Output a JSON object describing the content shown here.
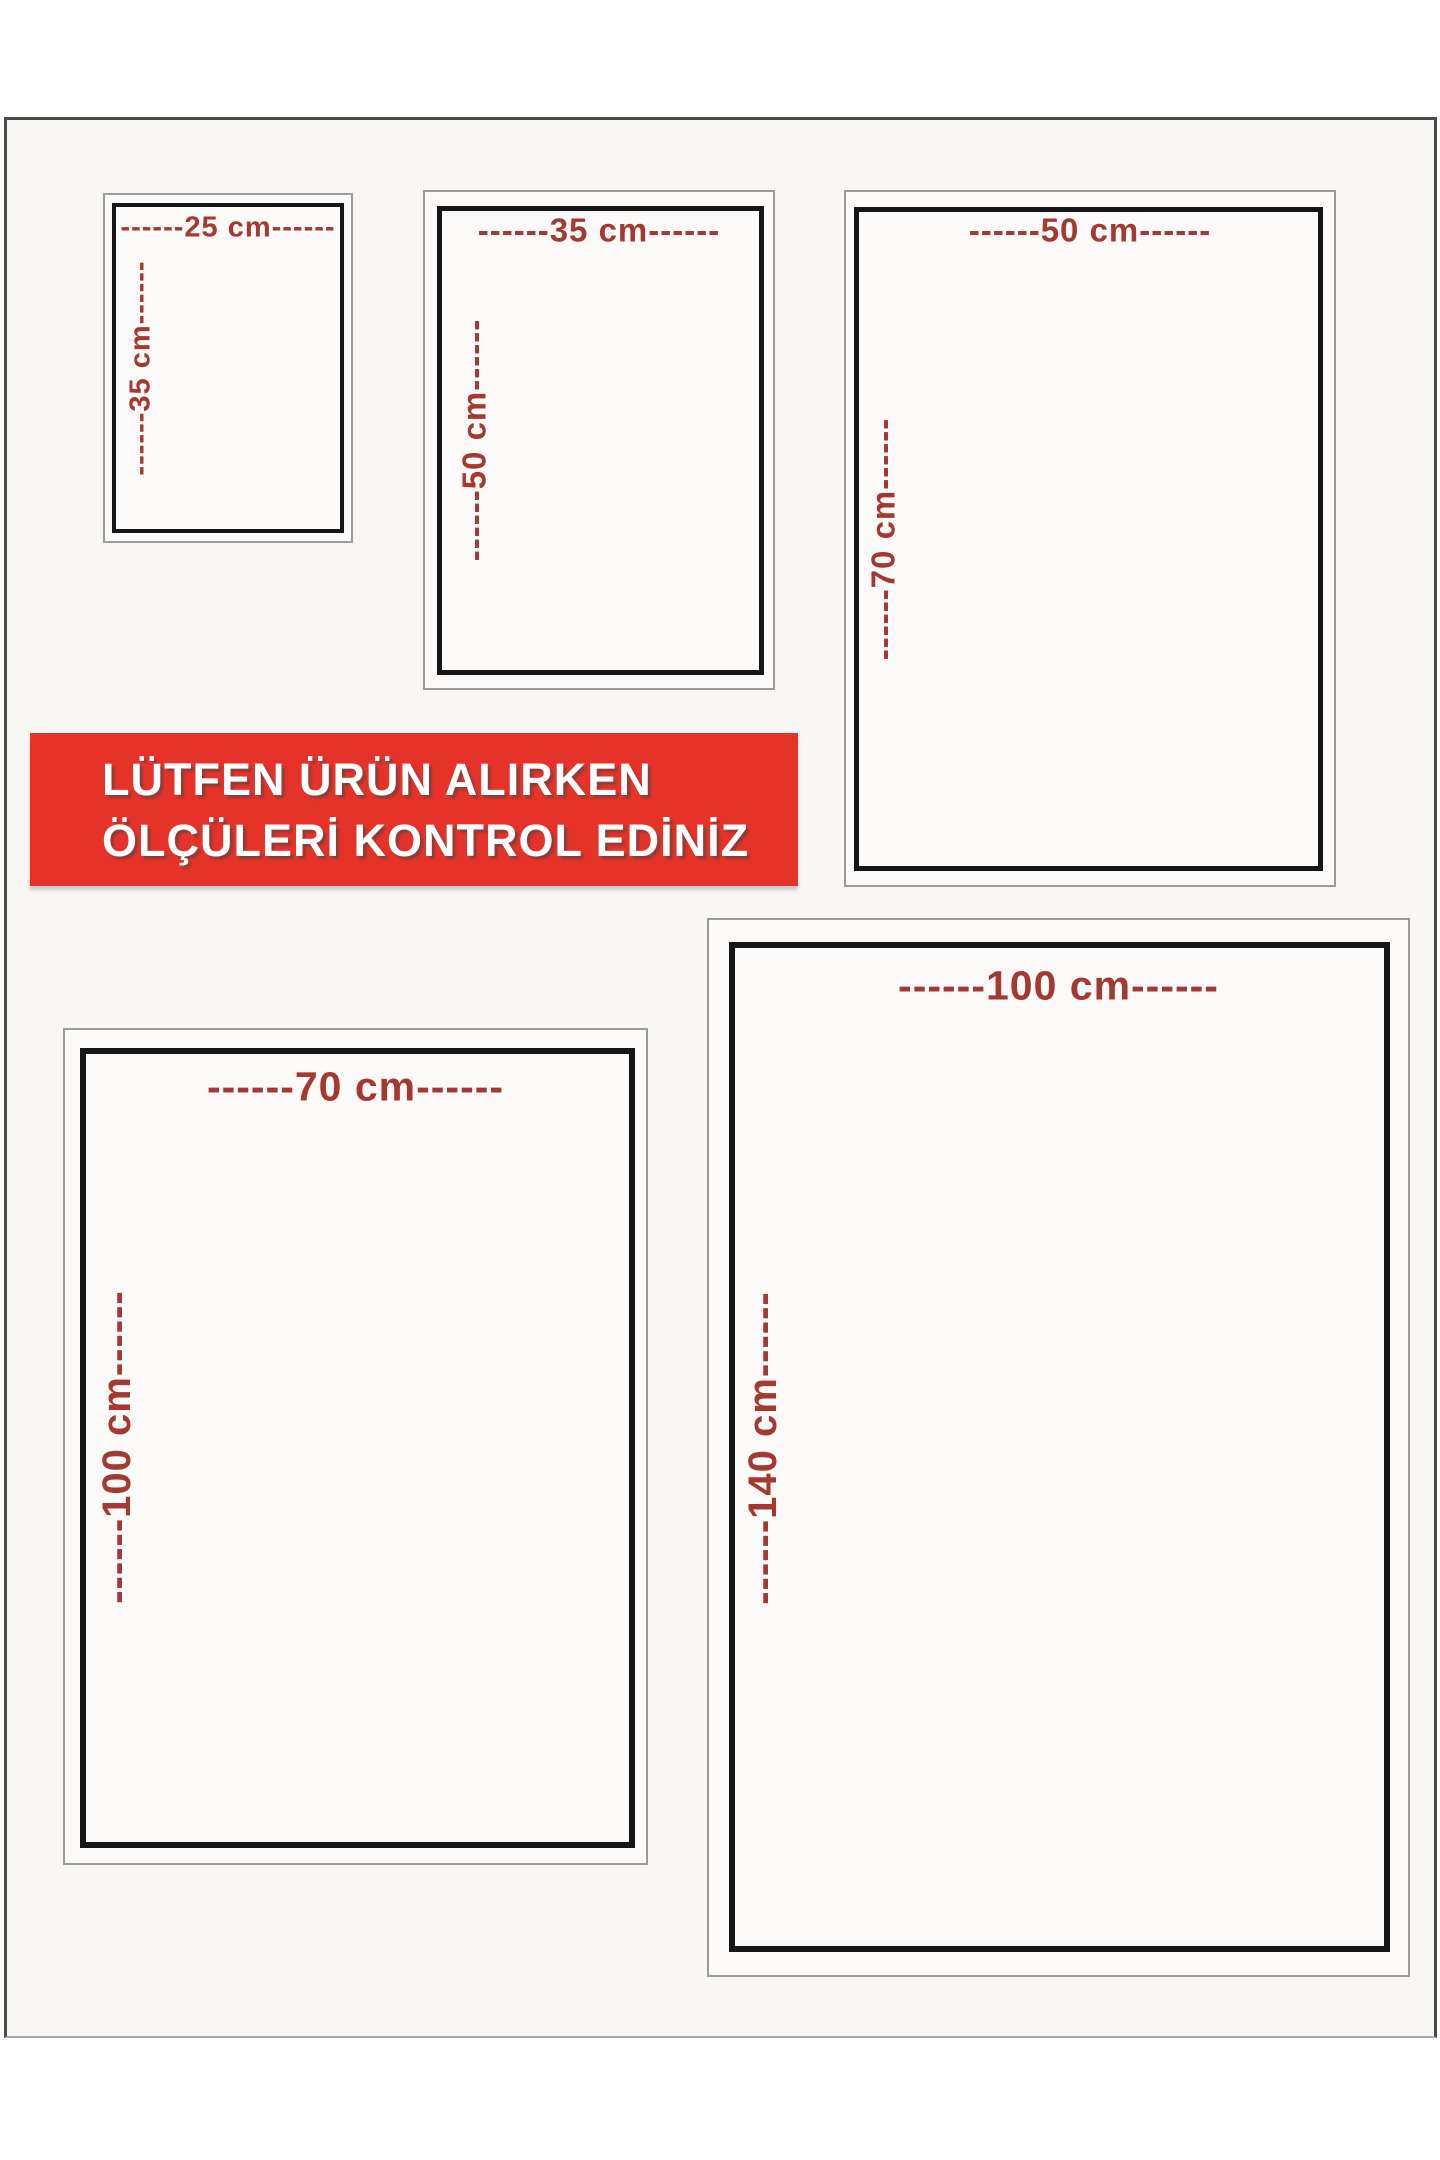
{
  "page": {
    "description": "Product size guide sheet",
    "sheet_background": "#f8f7f4",
    "frame_color": "#4a4a4a"
  },
  "banner": {
    "line1": "LÜTFEN ÜRÜN ALIRKEN",
    "line2": "ÖLÇÜLERİ KONTROL EDİNİZ",
    "bg_color": "#e63329",
    "text_color": "#ffffff"
  },
  "colors": {
    "dimension_label": "#a33931",
    "outer_box_border": "#9b9b9b",
    "inner_box_border": "#161616"
  },
  "sizes": [
    {
      "name": "25x35 cm",
      "width_cm": 25,
      "height_cm": 35,
      "width_label": "------25 cm------",
      "height_label": "------35 cm------"
    },
    {
      "name": "35x50 cm",
      "width_cm": 35,
      "height_cm": 50,
      "width_label": "------35 cm------",
      "height_label": "------50 cm------"
    },
    {
      "name": "50x70 cm",
      "width_cm": 50,
      "height_cm": 70,
      "width_label": "------50 cm------",
      "height_label": "------70 cm------"
    },
    {
      "name": "70x100 cm",
      "width_cm": 70,
      "height_cm": 100,
      "width_label": "------70 cm------",
      "height_label": "------100 cm------"
    },
    {
      "name": "100x140 cm",
      "width_cm": 100,
      "height_cm": 140,
      "width_label": "------100 cm------",
      "height_label": "------140 cm------"
    }
  ]
}
